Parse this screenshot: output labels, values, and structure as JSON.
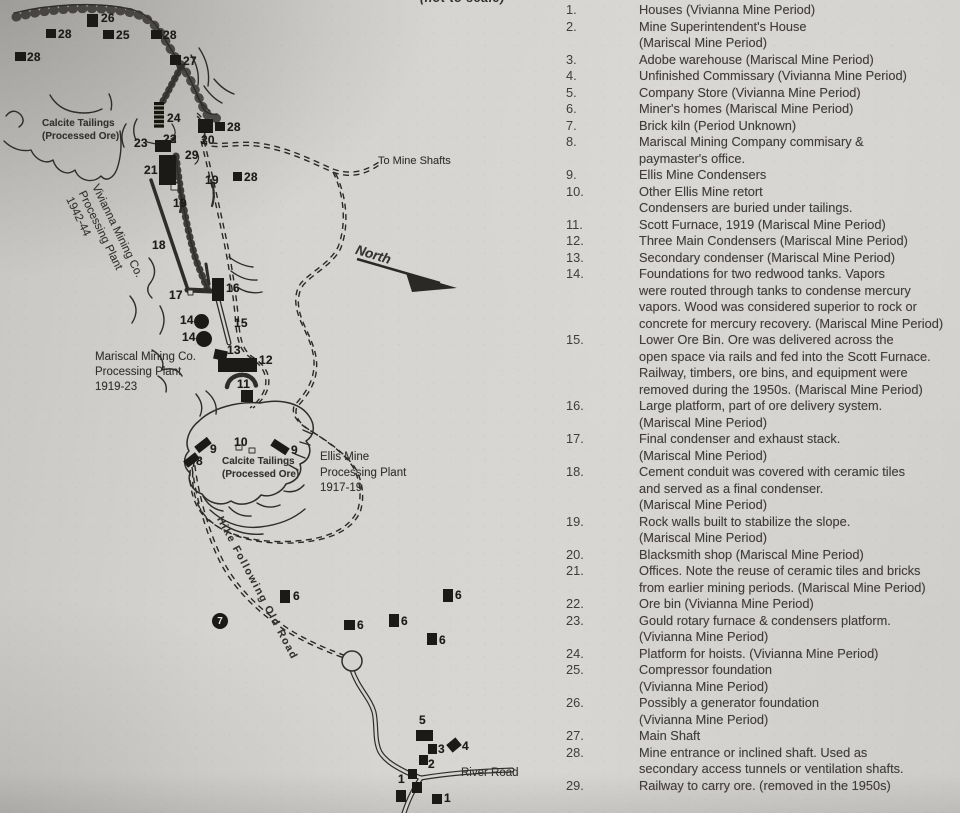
{
  "page": {
    "top_edge_fragment": "(not to scale)"
  },
  "map": {
    "labels": [
      {
        "id": "calcite-tailings-upper",
        "text": "Calcite Tailings\n(Processed Ore)",
        "x": 42,
        "y": 118,
        "size": 10,
        "bold": true,
        "rot": 0,
        "lh": 12.5
      },
      {
        "id": "vivianna-plant",
        "text": "Vivianna Mining Co.\nProcessing Plant\n1942-44",
        "x": 101,
        "y": 182,
        "size": 11.5,
        "bold": false,
        "rot": 64,
        "lh": 14.5
      },
      {
        "id": "mariscal-plant",
        "text": "Mariscal Mining Co.\nProcessing Plant\n1919-23",
        "x": 95,
        "y": 350,
        "size": 11.5,
        "bold": false,
        "rot": 0,
        "lh": 15
      },
      {
        "id": "ellis-plant",
        "text": "Ellis Mine\nProcessing Plant\n1917-19",
        "x": 320,
        "y": 450,
        "size": 11.5,
        "bold": false,
        "rot": 0,
        "lh": 15.5
      },
      {
        "id": "calcite-tailings-lower",
        "text": "Calcite Tailings\n(Processed Ore)",
        "x": 222,
        "y": 456,
        "size": 10,
        "bold": true,
        "rot": 0,
        "lh": 12.5
      },
      {
        "id": "to-mine-shafts",
        "text": "To Mine Shafts",
        "x": 378,
        "y": 155,
        "size": 11,
        "bold": false,
        "rot": 0,
        "lh": 13
      },
      {
        "id": "north",
        "text": "North",
        "x": 358,
        "y": 243,
        "size": 13.5,
        "bold": true,
        "italic": true,
        "rot": 17,
        "lh": 14
      },
      {
        "id": "hike-following-old-road",
        "text": "Hike Following Old Road",
        "x": 224,
        "y": 515,
        "size": 10.5,
        "bold": true,
        "rot": 62,
        "ls": 1.6,
        "lh": 11
      },
      {
        "id": "river-road",
        "text": "River Road",
        "x": 461,
        "y": 767,
        "size": 11.5,
        "bold": false,
        "rot": 0,
        "lh": 13
      }
    ],
    "markers": [
      {
        "n": "26",
        "x": 87,
        "y": 14,
        "w": 11,
        "h": 13,
        "lx": 101,
        "ly": 11
      },
      {
        "n": "28",
        "x": 46,
        "y": 29,
        "w": 10,
        "h": 9,
        "lx": 58,
        "ly": 27
      },
      {
        "n": "25",
        "x": 103,
        "y": 30,
        "w": 11,
        "h": 9,
        "lx": 116,
        "ly": 28
      },
      {
        "n": "28",
        "x": 151,
        "y": 30,
        "w": 11,
        "h": 9,
        "lx": 163,
        "ly": 28
      },
      {
        "n": "28",
        "x": 15,
        "y": 52,
        "w": 11,
        "h": 9,
        "lx": 27,
        "ly": 50
      },
      {
        "n": "27",
        "x": 170,
        "y": 55,
        "w": 11,
        "h": 10,
        "lx": 183,
        "ly": 54
      },
      {
        "n": "24",
        "x": 154,
        "y": 102,
        "w": 10,
        "h": 26,
        "hatch": true,
        "lx": 167,
        "ly": 111
      },
      {
        "n": "20",
        "x": 198,
        "y": 119,
        "w": 15,
        "h": 14,
        "lx": 201,
        "ly": 133
      },
      {
        "n": "28",
        "x": 215,
        "y": 122,
        "w": 10,
        "h": 9,
        "lx": 227,
        "ly": 120
      },
      {
        "n": "22",
        "x": 155,
        "y": 140,
        "w": 16,
        "h": 12,
        "lx": 163,
        "ly": 132
      },
      {
        "n": "21",
        "x": 159,
        "y": 155,
        "w": 17,
        "h": 30,
        "lx": 144,
        "ly": 163
      },
      {
        "n": "28",
        "x": 233,
        "y": 172,
        "w": 9,
        "h": 9,
        "lx": 244,
        "ly": 170
      },
      {
        "n": "16",
        "x": 212,
        "y": 278,
        "w": 12,
        "h": 23,
        "lx": 226,
        "ly": 281
      },
      {
        "n": "13",
        "x": 214,
        "y": 350,
        "w": 13,
        "h": 10,
        "rot": 12
      },
      {
        "n": "12",
        "x": 218,
        "y": 358,
        "w": 39,
        "h": 14,
        "lx": 259,
        "ly": 353
      },
      {
        "n": "11",
        "x": 241,
        "y": 390,
        "w": 12,
        "h": 12,
        "lx": 237,
        "ly": 377
      },
      {
        "n": "14",
        "x": 194,
        "y": 314,
        "w": 15,
        "h": 15,
        "circle": true,
        "lx": 180,
        "ly": 313
      },
      {
        "n": "14",
        "x": 196,
        "y": 331,
        "w": 16,
        "h": 16,
        "circle": true,
        "lx": 182,
        "ly": 330
      },
      {
        "n": "9",
        "x": 195,
        "y": 441,
        "w": 16,
        "h": 8,
        "rot": -38,
        "lx": 210,
        "ly": 442
      },
      {
        "n": "9",
        "x": 271,
        "y": 443,
        "w": 18,
        "h": 8,
        "rot": 33,
        "lx": 291,
        "ly": 443
      },
      {
        "n": "8",
        "x": 184,
        "y": 456,
        "w": 15,
        "h": 8,
        "rot": -38,
        "lx": 196,
        "ly": 454
      },
      {
        "n": "7",
        "x": 212,
        "y": 613,
        "w": 16,
        "h": 16,
        "circle": true,
        "inverse": true
      },
      {
        "n": "6",
        "x": 280,
        "y": 590,
        "w": 10,
        "h": 13,
        "lx": 293,
        "ly": 589
      },
      {
        "n": "6",
        "x": 344,
        "y": 620,
        "w": 11,
        "h": 10,
        "lx": 357,
        "ly": 618
      },
      {
        "n": "6",
        "x": 389,
        "y": 614,
        "w": 10,
        "h": 13,
        "lx": 401,
        "ly": 614
      },
      {
        "n": "6",
        "x": 443,
        "y": 589,
        "w": 10,
        "h": 13,
        "lx": 455,
        "ly": 588
      },
      {
        "n": "6",
        "x": 427,
        "y": 633,
        "w": 10,
        "h": 12,
        "lx": 439,
        "ly": 633
      },
      {
        "n": "5",
        "x": 416,
        "y": 730,
        "w": 17,
        "h": 11,
        "lx": 419,
        "ly": 713
      },
      {
        "n": "3",
        "x": 428,
        "y": 744,
        "w": 9,
        "h": 10,
        "lx": 438,
        "ly": 742
      },
      {
        "n": "4",
        "x": 448,
        "y": 740,
        "w": 12,
        "h": 10,
        "rot": -40,
        "lx": 462,
        "ly": 739
      },
      {
        "n": "2",
        "x": 419,
        "y": 755,
        "w": 9,
        "h": 10,
        "lx": 428,
        "ly": 757
      },
      {
        "n": "1",
        "x": 408,
        "y": 769,
        "w": 9,
        "h": 10,
        "lx": 398,
        "ly": 772
      },
      {
        "n": "",
        "x": 412,
        "y": 782,
        "w": 10,
        "h": 11
      },
      {
        "n": "",
        "x": 396,
        "y": 790,
        "w": 10,
        "h": 12
      },
      {
        "n": "1",
        "x": 432,
        "y": 794,
        "w": 10,
        "h": 10,
        "lx": 444,
        "ly": 791
      }
    ],
    "number_labels": [
      {
        "n": "23",
        "x": 134,
        "y": 136
      },
      {
        "n": "29",
        "x": 185,
        "y": 148
      },
      {
        "n": "19",
        "x": 205,
        "y": 173
      },
      {
        "n": "19",
        "x": 173,
        "y": 196
      },
      {
        "n": "18",
        "x": 152,
        "y": 238
      },
      {
        "n": "17",
        "x": 169,
        "y": 288
      },
      {
        "n": "15",
        "x": 234,
        "y": 316
      },
      {
        "n": "13",
        "x": 227,
        "y": 343
      },
      {
        "n": "10",
        "x": 234,
        "y": 435
      }
    ]
  },
  "legend": {
    "items": [
      {
        "num": "1.",
        "lines": [
          "Houses (Vivianna Mine Period)"
        ]
      },
      {
        "num": "2.",
        "lines": [
          "Mine Superintendent's House",
          "(Mariscal Mine Period)"
        ]
      },
      {
        "num": "3.",
        "lines": [
          "Adobe warehouse (Mariscal Mine Period)"
        ]
      },
      {
        "num": "4.",
        "lines": [
          "Unfinished Commissary (Vivianna Mine Period)"
        ]
      },
      {
        "num": "5.",
        "lines": [
          "Company Store (Vivianna Mine Period)"
        ]
      },
      {
        "num": "6.",
        "lines": [
          "Miner's homes (Mariscal Mine Period)"
        ]
      },
      {
        "num": "7.",
        "lines": [
          "Brick kiln (Period Unknown)"
        ]
      },
      {
        "num": "8.",
        "lines": [
          "Mariscal Mining Company commisary &",
          "paymaster's office."
        ]
      },
      {
        "num": "9.",
        "lines": [
          "Ellis Mine Condensers"
        ]
      },
      {
        "num": "10.",
        "lines": [
          "Other Ellis Mine retort",
          "Condensers are buried under tailings."
        ]
      },
      {
        "num": "11.",
        "lines": [
          "Scott Furnace, 1919 (Mariscal Mine Period)"
        ]
      },
      {
        "num": "12.",
        "lines": [
          "Three Main Condensers (Mariscal Mine Period)"
        ]
      },
      {
        "num": "13.",
        "lines": [
          "Secondary condenser (Mariscal Mine Period)"
        ]
      },
      {
        "num": "14.",
        "lines": [
          "Foundations for two redwood tanks.  Vapors",
          "were routed through tanks to condense mercury",
          "vapors.  Wood was considered superior to rock or",
          "concrete for mercury recovery. (Mariscal Mine Period)"
        ]
      },
      {
        "num": "15.",
        "lines": [
          "Lower Ore Bin.  Ore was delivered across the",
          "open space via rails  and fed into the Scott Furnace.",
          "Railway, timbers, ore bins, and equipment were",
          "removed during the 1950s. (Mariscal Mine Period)"
        ]
      },
      {
        "num": "16.",
        "lines": [
          "Large platform, part of ore delivery system.",
          "(Mariscal Mine Period)"
        ]
      },
      {
        "num": "17.",
        "lines": [
          "Final condenser and exhaust stack.",
          "(Mariscal Mine Period)"
        ]
      },
      {
        "num": "18.",
        "lines": [
          "Cement conduit was covered with ceramic tiles",
          "and served as a final condenser.",
          "(Mariscal Mine Period)"
        ]
      },
      {
        "num": "19.",
        "lines": [
          "Rock walls built to stabilize the slope.",
          "(Mariscal Mine Period)"
        ]
      },
      {
        "num": "20.",
        "lines": [
          "Blacksmith shop (Mariscal Mine Period)"
        ]
      },
      {
        "num": "21.",
        "lines": [
          "Offices.  Note the reuse of ceramic tiles and bricks",
          "from earlier mining periods. (Mariscal Mine Period)"
        ]
      },
      {
        "num": "22.",
        "lines": [
          "Ore bin (Vivianna Mine Period)"
        ]
      },
      {
        "num": "23.",
        "lines": [
          "Gould rotary furnace & condensers platform.",
          "(Vivianna Mine Period)"
        ]
      },
      {
        "num": "24.",
        "lines": [
          "Platform for hoists. (Vivianna Mine Period)"
        ]
      },
      {
        "num": "25.",
        "lines": [
          "Compressor foundation",
          "(Vivianna Mine Period)"
        ]
      },
      {
        "num": "26.",
        "lines": [
          "Possibly a generator foundation",
          "(Vivianna Mine Period)"
        ]
      },
      {
        "num": "27.",
        "lines": [
          "Main Shaft"
        ]
      },
      {
        "num": "28.",
        "lines": [
          "Mine entrance or inclined shaft.  Used as",
          "secondary access tunnels or ventilation shafts."
        ]
      },
      {
        "num": "29.",
        "lines": [
          "Railway to carry ore.  (removed in the 1950s)"
        ]
      }
    ]
  }
}
